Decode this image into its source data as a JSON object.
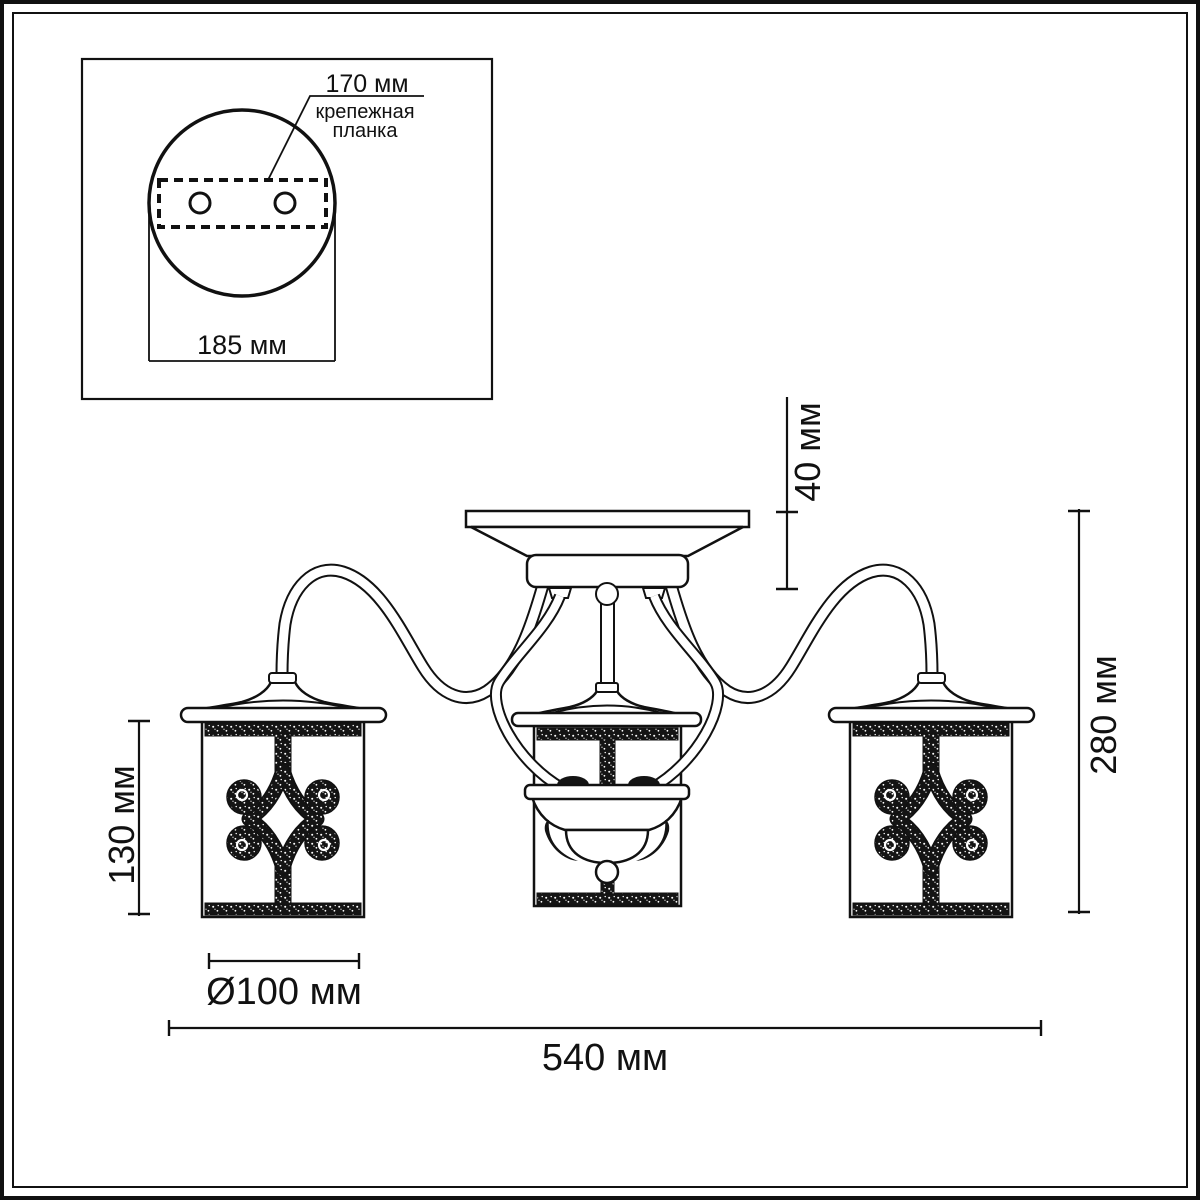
{
  "inset": {
    "bracket_length_label": "170 мм",
    "bracket_name_line1": "крепежная",
    "bracket_name_line2": "планка",
    "plate_width_label": "185 мм"
  },
  "dimensions": {
    "canopy_height": "40 мм",
    "fixture_height": "280 мм",
    "lantern_height": "130 мм",
    "lantern_diameter": "Ø100 мм",
    "fixture_width": "540 мм"
  },
  "colors": {
    "line": "#111111",
    "background": "#ffffff"
  }
}
